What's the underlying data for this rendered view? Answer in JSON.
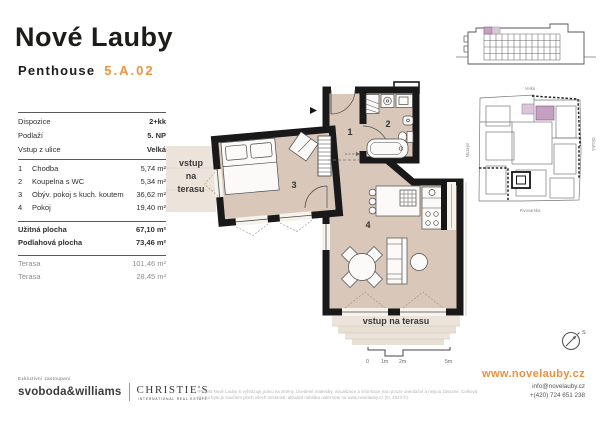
{
  "colors": {
    "accent": "#ee9340",
    "floor": "#d9c8ba",
    "terrace": "#ece4da",
    "wall": "#191919",
    "highlight_purple": "#c4a1c1"
  },
  "header": {
    "brand": "Nové Lauby",
    "unit_type": "Penthouse",
    "unit_id": "5.A.02"
  },
  "info": {
    "summary": [
      {
        "label": "Dispozice",
        "value": "2+kk"
      },
      {
        "label": "Podlaží",
        "value": "5. NP"
      },
      {
        "label": "Vstup z ulice",
        "value": "Velká"
      }
    ],
    "rooms": [
      {
        "num": "1",
        "name": "Chodba",
        "area": "5,74 m²"
      },
      {
        "num": "2",
        "name": "Koupelna s WC",
        "area": "5,34 m²"
      },
      {
        "num": "3",
        "name": "Obýv. pokoj s kuch. koutem",
        "area": "36,62 m²"
      },
      {
        "num": "4",
        "name": "Pokoj",
        "area": "19,40 m²"
      }
    ],
    "totals": [
      {
        "label": "Užitná plocha",
        "value": "67,10 m²"
      },
      {
        "label": "Podlahová plocha",
        "value": "73,46 m²"
      }
    ],
    "terraces": [
      {
        "label": "Terasa",
        "value": "101,46 m²"
      },
      {
        "label": "Terasa",
        "value": "28,45 m²"
      }
    ]
  },
  "floorplan": {
    "room_labels": [
      "1",
      "2",
      "3",
      "4"
    ],
    "terrace_left_lines": [
      "vstup",
      "na",
      "terasu"
    ],
    "terrace_bottom": "vstup na terasu",
    "scale": [
      "0",
      "1m",
      "2m",
      "5m"
    ],
    "compass": "S"
  },
  "siteplan": {
    "streets": {
      "top": "Velká",
      "left": "Muzejní",
      "bottom": "Pivovarská",
      "right": "Dlouhá"
    }
  },
  "footer": {
    "exclusive": "Exkluzivní zastoupení",
    "agency_primary": "svoboda&williams",
    "agency_secondary": "CHRISTIE'S",
    "agency_secondary_sub": "INTERNATIONAL REAL ESTATE",
    "disclaimer": "*Projekt Nové Lauby si vyhrazuje právo na změny. Uvedené materiály, vizualizace a informace jsou pouze orientační a nejsou závazné. Celková plocha bytu je součtem ploch všech místností, aktuální nabídku naleznete na www.novelauby.cz (III. 2023 ©).",
    "website": "www.novelauby.cz",
    "email": "info@novelauby.cz",
    "phone": "+(420) 724 651 238"
  }
}
